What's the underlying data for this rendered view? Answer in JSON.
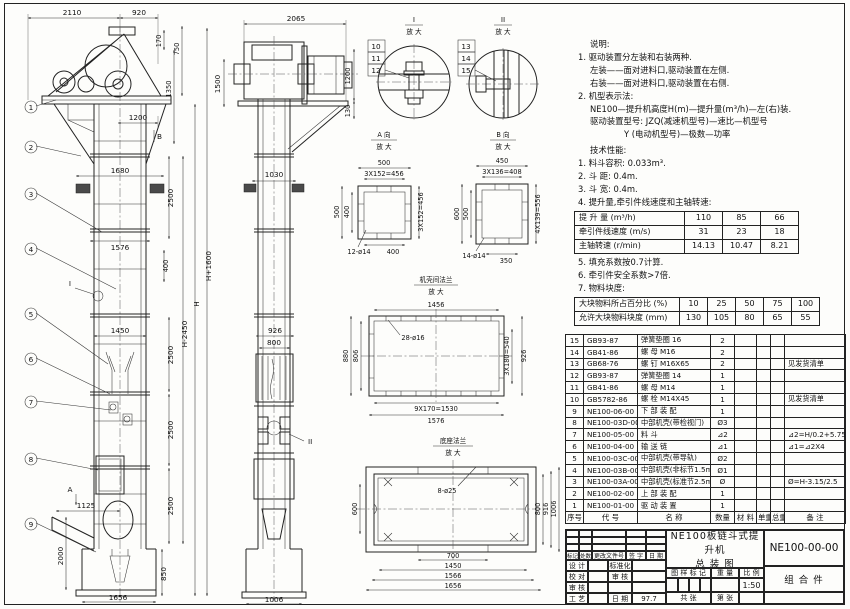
{
  "notes": {
    "heading": "说明:",
    "lines": [
      "1. 驱动装置分左装和右装两种.",
      "左装——面对进料口,驱动装置在左侧.",
      "右装——面对进料口,驱动装置在右侧.",
      "2. 机型表示法:",
      "NE100—提升机高度H(m)—提升量(m³/h)—左(右)装.",
      "驱动装置型号: JZQ(减速机型号)—速比—机型号",
      "Y (电动机型号)—极数—功率"
    ]
  },
  "tech": {
    "heading": "技术性能:",
    "items_before": [
      "1. 料斗容积: 0.033m³.",
      "2. 斗  距: 0.4m.",
      "3. 斗  宽: 0.4m.",
      "4. 提升量,牵引件线速度和主轴转速:"
    ],
    "items_after": [
      "5. 填充系数按0.7计算.",
      "6. 牵引件安全系数>7倍.",
      "7. 物料块度:"
    ]
  },
  "speed_table": {
    "rows": [
      [
        "提 升 量  (m³/h)",
        "110",
        "85",
        "66"
      ],
      [
        "牵引件线速度 (m/s)",
        "31",
        "23",
        "18"
      ],
      [
        "主轴转速 (r/min)",
        "14.13",
        "10.47",
        "8.21"
      ]
    ]
  },
  "lump_table": {
    "rows": [
      [
        "大块物料所占百分比 (%)",
        "10",
        "25",
        "50",
        "75",
        "100"
      ],
      [
        "允许大块物料块度 (mm)",
        "130",
        "105",
        "80",
        "65",
        "55"
      ]
    ]
  },
  "bom": {
    "headers": [
      "序号",
      "代  号",
      "名  称",
      "数量",
      "材 料",
      "单重",
      "总重",
      "备 注"
    ],
    "rows": [
      [
        "15",
        "GB93-87",
        "弹簧垫圈 16",
        "2",
        "",
        "",
        "",
        ""
      ],
      [
        "14",
        "GB41-86",
        "螺 母  M16",
        "2",
        "",
        "",
        "",
        ""
      ],
      [
        "13",
        "GB68-76",
        "螺 钉  M16X65",
        "2",
        "",
        "",
        "",
        "见发货清单"
      ],
      [
        "12",
        "GB93-87",
        "弹簧垫圈 14",
        "1",
        "",
        "",
        "",
        ""
      ],
      [
        "11",
        "GB41-86",
        "螺 母  M14",
        "1",
        "",
        "",
        "",
        ""
      ],
      [
        "10",
        "GB5782-86",
        "螺 栓  M14X45",
        "1",
        "",
        "",
        "",
        "见发货清单"
      ],
      [
        "9",
        "NE100-06-00",
        "下 部 装 配",
        "1",
        "",
        "",
        "",
        ""
      ],
      [
        "8",
        "NE100-03D-00",
        "中部机壳(带检视门)",
        "Ø3",
        "",
        "",
        "",
        ""
      ],
      [
        "7",
        "NE100-05-00",
        "料 斗",
        "⊿2",
        "",
        "",
        "",
        "⊿2=H/0.2+5.75"
      ],
      [
        "6",
        "NE100-04-00",
        "输 送 链",
        "⊿1",
        "",
        "",
        "",
        "⊿1=⊿2X4"
      ],
      [
        "5",
        "NE100-03C-00",
        "中部机壳(带导轨)",
        "Ø2",
        "",
        "",
        "",
        ""
      ],
      [
        "4",
        "NE100-03B-00",
        "中部机壳(非标节1.5m,1m)",
        "Ø1",
        "",
        "",
        "",
        ""
      ],
      [
        "3",
        "NE100-03A-00",
        "中部机壳(标准节2.5m)",
        "Ø",
        "",
        "",
        "",
        "Ø=H-3.15/2.5"
      ],
      [
        "2",
        "NE100-02-00",
        "上 部 装 配",
        "1",
        "",
        "",
        "",
        ""
      ],
      [
        "1",
        "NE100-01-00",
        "驱 动 装 置",
        "1",
        "",
        "",
        "",
        ""
      ]
    ]
  },
  "titleblock": {
    "product": "NE100板链斗式提升机",
    "subtitle": "总  装  图",
    "code": "NE100-00-00",
    "part_type": "组 合 件",
    "rev_headers": [
      "标记",
      "处数",
      "更改文件号",
      "签 字",
      "日 期"
    ],
    "roles": [
      [
        "设 计",
        "标准化"
      ],
      [
        "校 对",
        "审 核"
      ],
      [
        "审 核",
        ""
      ],
      [
        "工 艺",
        "日 期"
      ]
    ],
    "date": "97.7",
    "stamp_headers": [
      "图 样 标 记",
      "重 量",
      "比 例"
    ],
    "scale": "1:50",
    "sheet_total": "共  张",
    "sheet_no": "第  张"
  },
  "dims": {
    "front": {
      "d2110": "2110",
      "d920": "920",
      "d170": "170",
      "d750": "750",
      "d1350": "1350",
      "d1200": "1200",
      "d1680": "1680",
      "d2500": "2500",
      "d1576": "1576",
      "d400": "400",
      "d1450": "1450",
      "dHm": "H-2450",
      "dH": "H",
      "dHp": "H+1600",
      "d1125": "1125",
      "d2000": "2000",
      "d850": "850",
      "d1656": "1656"
    },
    "side": {
      "d2065": "2065",
      "d1500": "1500",
      "d1200": "1200",
      "d130": "130",
      "d1030": "1030",
      "d926": "926",
      "d800": "800",
      "d1006": "1006"
    },
    "va": {
      "d500": "500",
      "d456": "3X152=456",
      "d400": "400",
      "holes": "12-ø14"
    },
    "vb": {
      "d450": "450",
      "d408": "3X136=408",
      "d600": "600",
      "d500": "500",
      "d556": "4X139=556",
      "d350": "350",
      "holes": "14-ø14"
    },
    "fl": {
      "d1456": "1456",
      "d880": "880",
      "d806": "806",
      "d540": "3X180=540",
      "d926": "926",
      "d1530": "9X170=1530",
      "d1576": "1576",
      "holes": "28-ø16"
    },
    "ba": {
      "holes": "8-ø25",
      "d600": "600",
      "d800": "800",
      "d916": "916",
      "d1006": "1006",
      "d700": "700",
      "d1450": "1450",
      "d1566": "1566",
      "d1656": "1656"
    }
  },
  "labels": {
    "balloons": [
      "1",
      "2",
      "3",
      "4",
      "5",
      "6",
      "7",
      "8",
      "9",
      "10",
      "11",
      "12",
      "13",
      "14",
      "15"
    ],
    "detail1": "I",
    "detail2": "II",
    "enlarged": "放 大",
    "viewA": "A 向",
    "viewB": "B 向",
    "flange_title": "机壳间法兰",
    "base_title": "底座法兰",
    "markerA": "A",
    "markerB": "B",
    "markerI": "I",
    "markerII": "II"
  }
}
